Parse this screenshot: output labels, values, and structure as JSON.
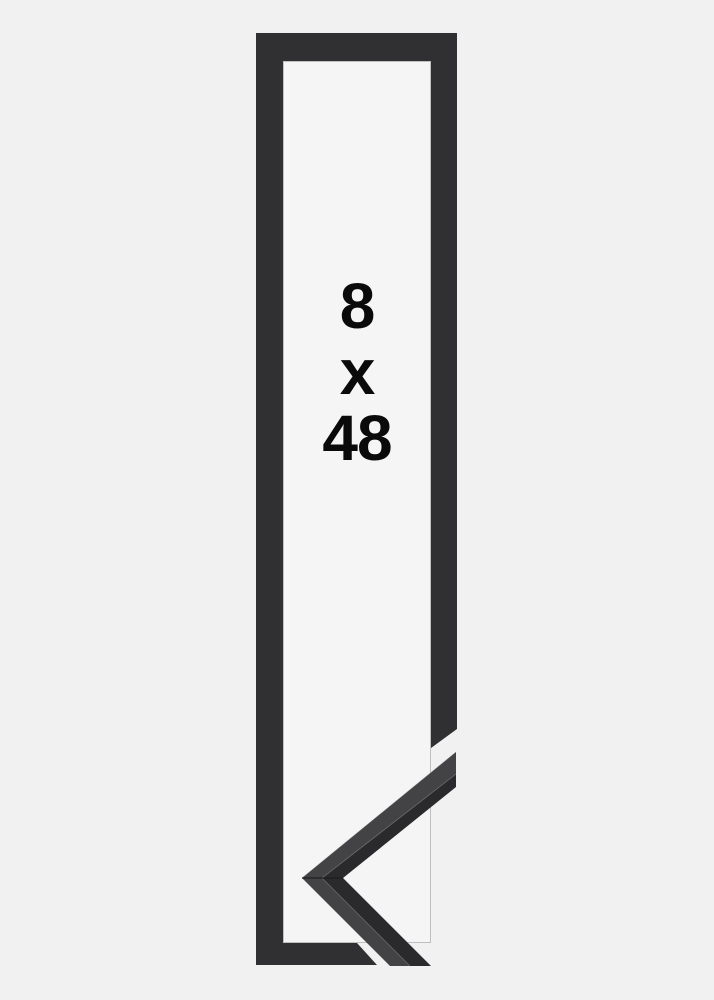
{
  "product_image": {
    "size_label": {
      "width_value": "8",
      "separator": "x",
      "height_value": "48"
    }
  },
  "colors": {
    "background": "#f1f1f2",
    "frame": "#303032",
    "frame_inner_edge": "rgba(0,0,0,0.22)",
    "frame_interior": "#f5f5f6",
    "moulding_face": "#434345",
    "moulding_edge_dark": "#2a2a2c",
    "moulding_seam": "#1c1c1e",
    "moulding_highlight": "#7a7a7d",
    "label_text": "#0a0a0a"
  }
}
